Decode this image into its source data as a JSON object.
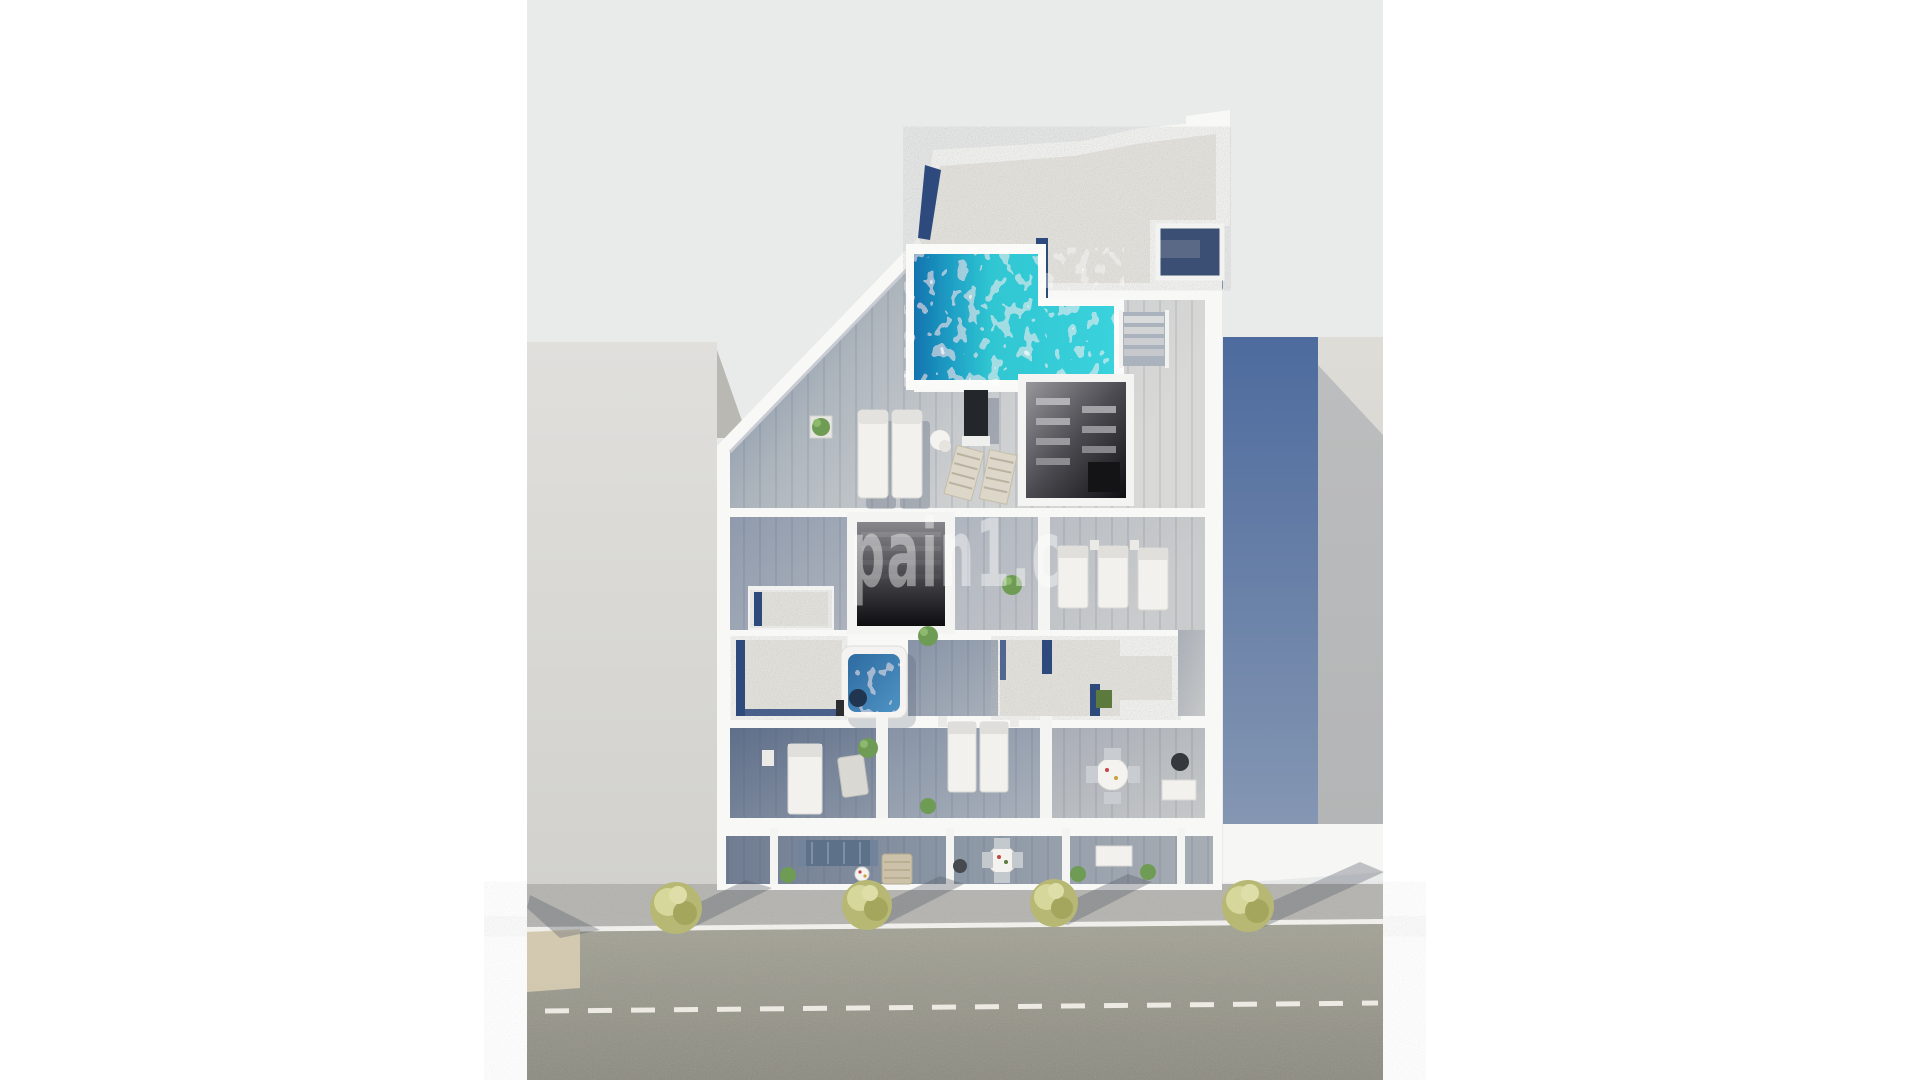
{
  "watermark": {
    "text": "pain1.c",
    "color": "#ffffff",
    "opacity": 0.42
  },
  "colors": {
    "page_bg": "#ffffff",
    "render_bg": "#e9eaea",
    "white_wall": "#f8f8f6",
    "gravel": "#e6e4de",
    "navy_trim": "#2e4a7d",
    "pool_water": "#2fcbd6",
    "pool_deep": "#1173ae",
    "deck_blue": "#7e8ca3",
    "floor_mid": "#b7bdc5",
    "neighbor_left": "#dedddb",
    "neighbor_left_shade": "#b9b8b2",
    "neighbor_right_blue": "#54719f",
    "neighbor_right_gray": "#dbd9d4",
    "sidewalk": "#b4b3af",
    "road": "#9a998c",
    "road_marking": "#eceae2",
    "curb_white": "#f4f3ef",
    "driveway_beige": "#d8cdb4",
    "tree": "#b6b873",
    "tree_light": "#d6d79b",
    "tree_dark": "#a3a65c",
    "tree_shadow": "#565c66",
    "sofa_blue": "#5d7188",
    "daybed_tan": "#cbc2a9",
    "hot_tub_water": "#3f7fb2",
    "plant_green": "#6f9c55",
    "tv_dark": "#23262b",
    "stair_dark": "#141417",
    "lounger_white": "#f2f1ee"
  },
  "scene_objects": [
    {
      "name": "rooftop-pool",
      "desc": "L-shaped turquoise swimming pool on roof terrace"
    },
    {
      "name": "gravel-roof",
      "desc": "white gravel flat roof with navy trim"
    },
    {
      "name": "solarium-deck",
      "desc": "wood deck with two sun loungers and two folding chairs"
    },
    {
      "name": "tv-panel",
      "desc": "dark outdoor screen on deck"
    },
    {
      "name": "stair-core",
      "desc": "dark open staircase room seen from above"
    },
    {
      "name": "stairwell-opening",
      "desc": "dark stairwell opening on middle floor"
    },
    {
      "name": "hot-tub",
      "desc": "square white hot tub with blue water"
    },
    {
      "name": "bedroom-twin-beds",
      "desc": "two white single beds"
    },
    {
      "name": "dining-set",
      "desc": "round white table with four chairs"
    },
    {
      "name": "ground-terraces",
      "desc": "three street-level terraces with sofa, dining table and desk"
    },
    {
      "name": "left-neighbor-building",
      "desc": "flat light roof slab of adjacent building"
    },
    {
      "name": "right-neighbor-building",
      "desc": "adjacent building with blue side wall"
    },
    {
      "name": "sidewalk",
      "desc": "gray pavement with four yellow-green trees"
    },
    {
      "name": "road",
      "desc": "asphalt street with dashed white center line"
    }
  ]
}
